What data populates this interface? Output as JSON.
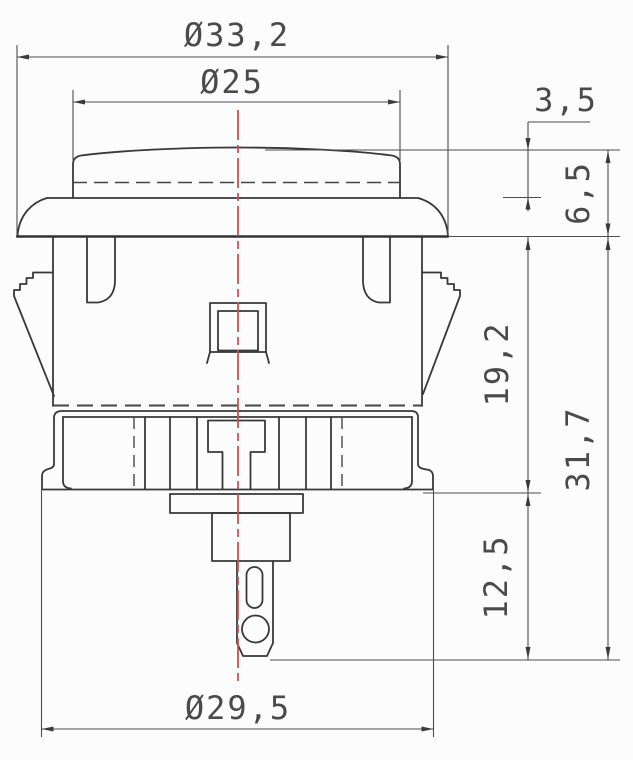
{
  "drawing": {
    "type": "engineering-dimension-drawing",
    "subject": "push-button side cross-section",
    "dimensions": {
      "flange_diameter": "Ø33,2",
      "plunger_diameter": "Ø25",
      "plunger_protrusion": "3,5",
      "cap_height": "6,5",
      "body_depth": "19,2",
      "overall_depth": "31,7",
      "terminal_depth": "12,5",
      "body_diameter": "Ø29,5"
    },
    "colors": {
      "outline": "#383838",
      "dimension_lines": "#4d4d4d",
      "label_text": "#4a4a4a",
      "centerline": "#c4544e",
      "background": "#fcfcfc"
    }
  }
}
